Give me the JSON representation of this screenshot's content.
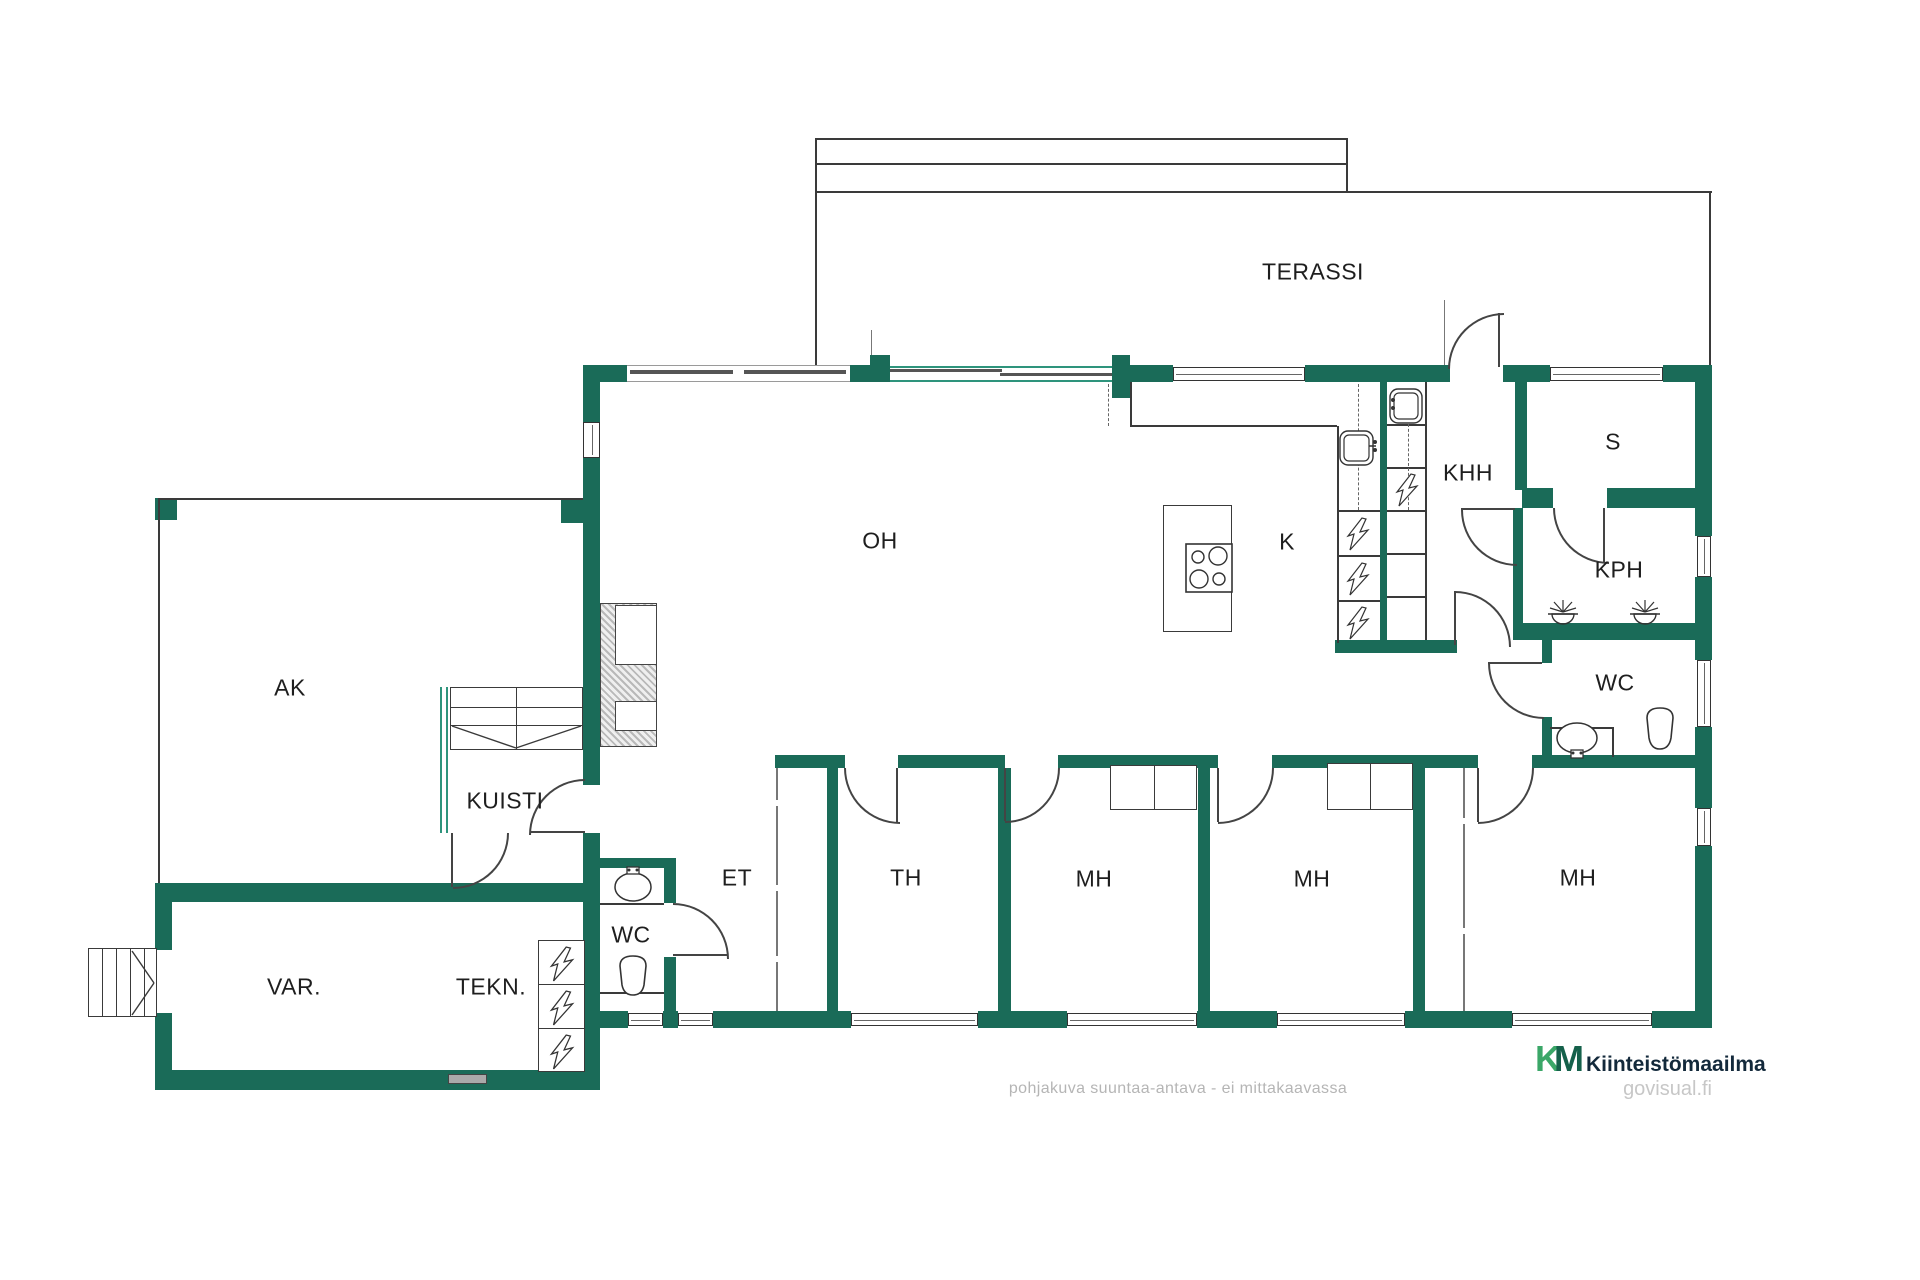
{
  "colors": {
    "wall_green": "#1A6B58",
    "thin_wall_green": "#2E947C",
    "line": "#3a3a3a",
    "label_text": "#1e1e1e",
    "muted_text": "#b5b5b5",
    "logo_k_green": "#3BA768",
    "logo_m_green": "#15614B",
    "logo_name_navy": "#13293B",
    "watermark_gray": "#c7c7c7"
  },
  "rooms": {
    "terassi": "TERASSI",
    "oh": "OH",
    "k": "K",
    "khh": "KHH",
    "s": "S",
    "kph": "KPH",
    "wc_right": "WC",
    "ak": "AK",
    "kuisti": "KUISTI",
    "et": "ET",
    "th": "TH",
    "mh1": "MH",
    "mh2": "MH",
    "mh3": "MH",
    "wc_left": "WC",
    "var": "VAR.",
    "tekn": "TEKN."
  },
  "footer": {
    "disclaimer": "pohjakuva suuntaa-antava - ei mittakaavassa",
    "logo_k": "K",
    "logo_m": "M",
    "logo_name": "Kiinteistömaailma",
    "watermark": "govisual.fi"
  }
}
